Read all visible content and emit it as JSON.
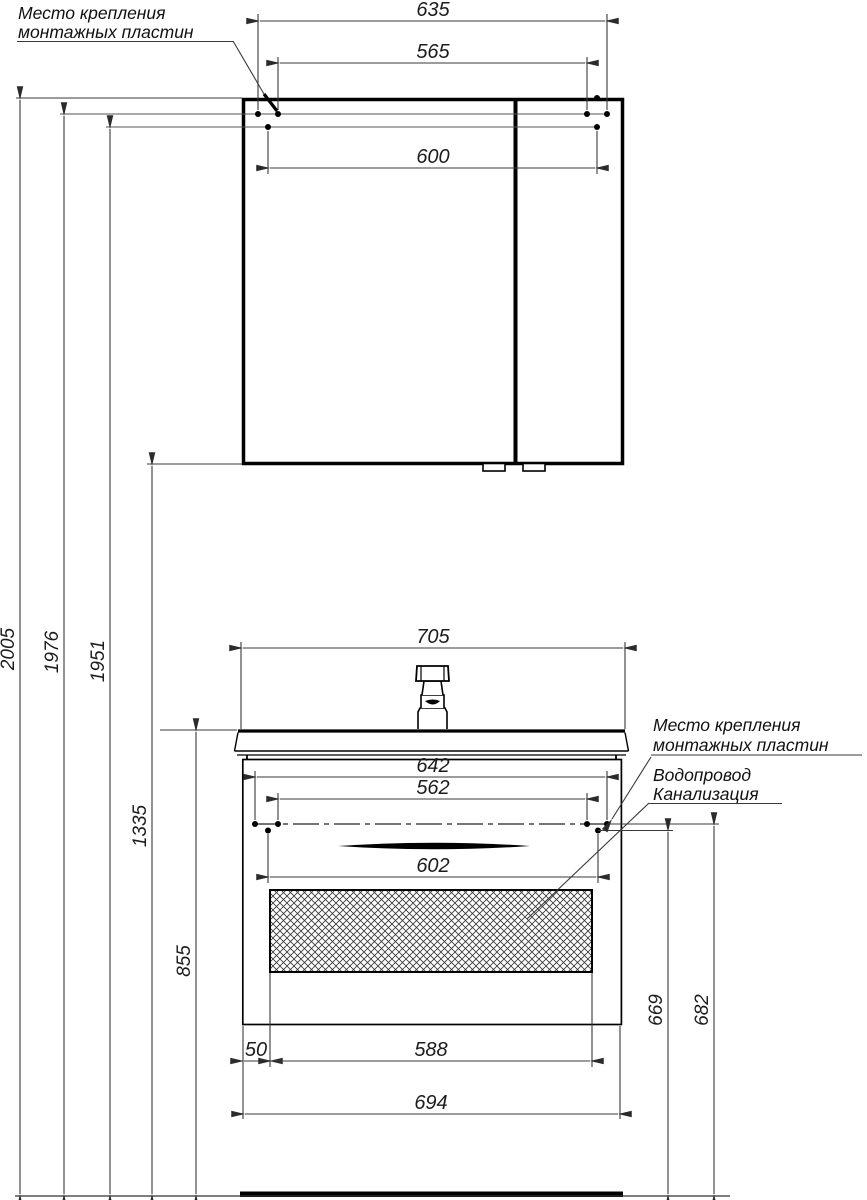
{
  "labels": {
    "mounting_plates": {
      "line1": "Место крепления",
      "line2": "монтажных пластин"
    },
    "water_supply": "Водопровод",
    "sewerage": "Канализация"
  },
  "dimensions": {
    "mirror": {
      "outer_mount_width": "635",
      "inner_mount_width": "565",
      "width": "600"
    },
    "vanity": {
      "sink_width": "705",
      "mount_outer": "642",
      "mount_inner": "562",
      "body_width": "602",
      "drawer_side_offset": "50",
      "drawer_width": "588",
      "width": "694"
    },
    "heights": {
      "total": "2005",
      "mirror_mount_upper": "1976",
      "mirror_mount_lower": "1951",
      "mirror_bottom": "1335",
      "sink_top": "855",
      "vanity_mount_lower": "669",
      "vanity_mount_upper": "682"
    }
  }
}
